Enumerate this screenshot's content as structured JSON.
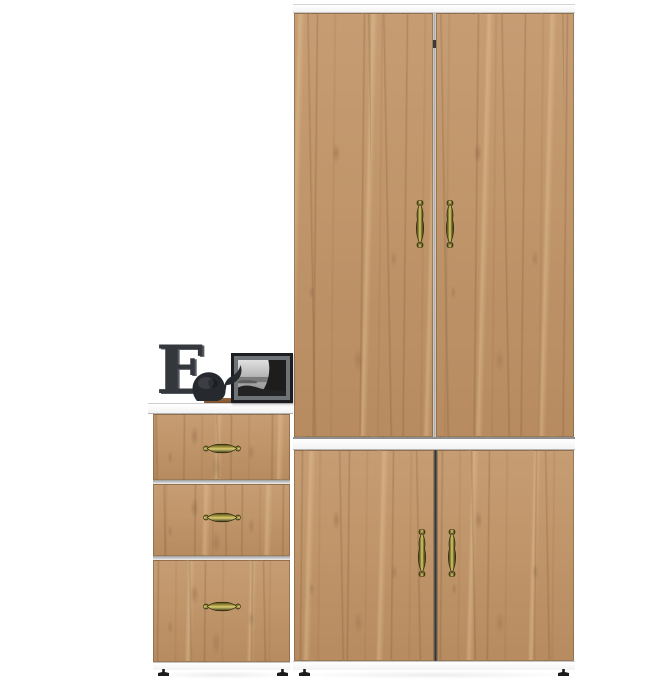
{
  "scene": {
    "type": "furniture product render",
    "description": "Oak-finish hallway set: tall two-door wardrobe with two lower cabinet doors on the right, three-drawer chest on the left, decorated with a letter ornament, a black elephant figurine and a framed monochrome seascape photo",
    "background_color": "#ffffff"
  },
  "palette": {
    "wood_base": "#c09366",
    "wood_grain_dark": "#7a5430",
    "wood_grain_light": "#ebcda0",
    "trim_white": "#f7f7f7",
    "edge_gray": "#8f8f8f",
    "handle_brass_dark": "#3f3814",
    "handle_brass_mid": "#8d8135",
    "handle_brass_light": "#d9cc74",
    "decor_charcoal": "#34373c",
    "figurine_black": "#26292e",
    "frame_black": "#1b1d20",
    "matte_gray": "#6e7378",
    "plank_brown": "#8a5a38",
    "foot_black": "#1c1c1c"
  },
  "wardrobe": {
    "label": "tall wardrobe with lower cabinet",
    "upper_doors": [
      "upper-left-door",
      "upper-right-door"
    ],
    "lower_doors": [
      "lower-left-door",
      "lower-right-door"
    ],
    "handle_style": "antique brass vertical spindle",
    "handle_count": 4,
    "top_trim": "white",
    "middle_divider": "white",
    "base_trim": "white"
  },
  "chest": {
    "label": "three-drawer chest",
    "drawer_count": 3,
    "handle_style": "antique brass horizontal spindle",
    "top_surface": "white"
  },
  "decor": {
    "letter": {
      "glyph": "E",
      "color": "#34373c"
    },
    "figurine": {
      "type": "elephant",
      "color": "#26292e"
    },
    "photo_frame": {
      "frame_color": "#1b1d20",
      "matte_color": "#6e7378",
      "photo": "monochrome coastal scene with dark cliff"
    },
    "plank": {
      "color": "#8a5a38"
    }
  },
  "feet": {
    "count": 4,
    "color": "#1c1c1c"
  }
}
